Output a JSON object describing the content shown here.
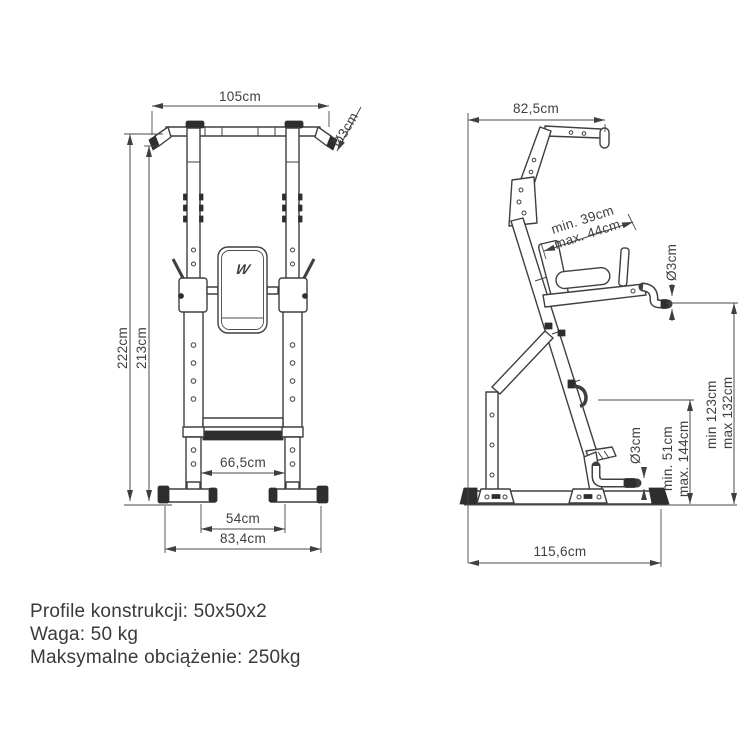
{
  "colors": {
    "line": "#3f3f3f",
    "background": "#ffffff",
    "dark_fill": "#2e2e2e"
  },
  "front_view": {
    "logo": "W",
    "dims": {
      "top_width": "105cm",
      "bar_diameter": "Ø3cm",
      "height_total": "222cm",
      "height_bar": "213cm",
      "inner_width": "66,5cm",
      "foot_inner_width": "54cm",
      "base_width": "83,4cm"
    }
  },
  "side_view": {
    "dims": {
      "top_depth": "82,5cm",
      "grip_spacing_min": "min. 39cm",
      "grip_spacing_max": "max. 44cm",
      "dip_bar_diameter": "Ø3cm",
      "dip_height_min": "min 123cm",
      "dip_height_max": "max 132cm",
      "step_height_min": "min. 51cm",
      "step_height_max": "max. 144cm",
      "step_bar_diameter": "Ø3cm",
      "base_depth": "115,6cm"
    }
  },
  "specs": {
    "line1": "Profile konstrukcji: 50x50x2",
    "line2": "Waga: 50 kg",
    "line3": "Maksymalne obciążenie: 250kg"
  }
}
